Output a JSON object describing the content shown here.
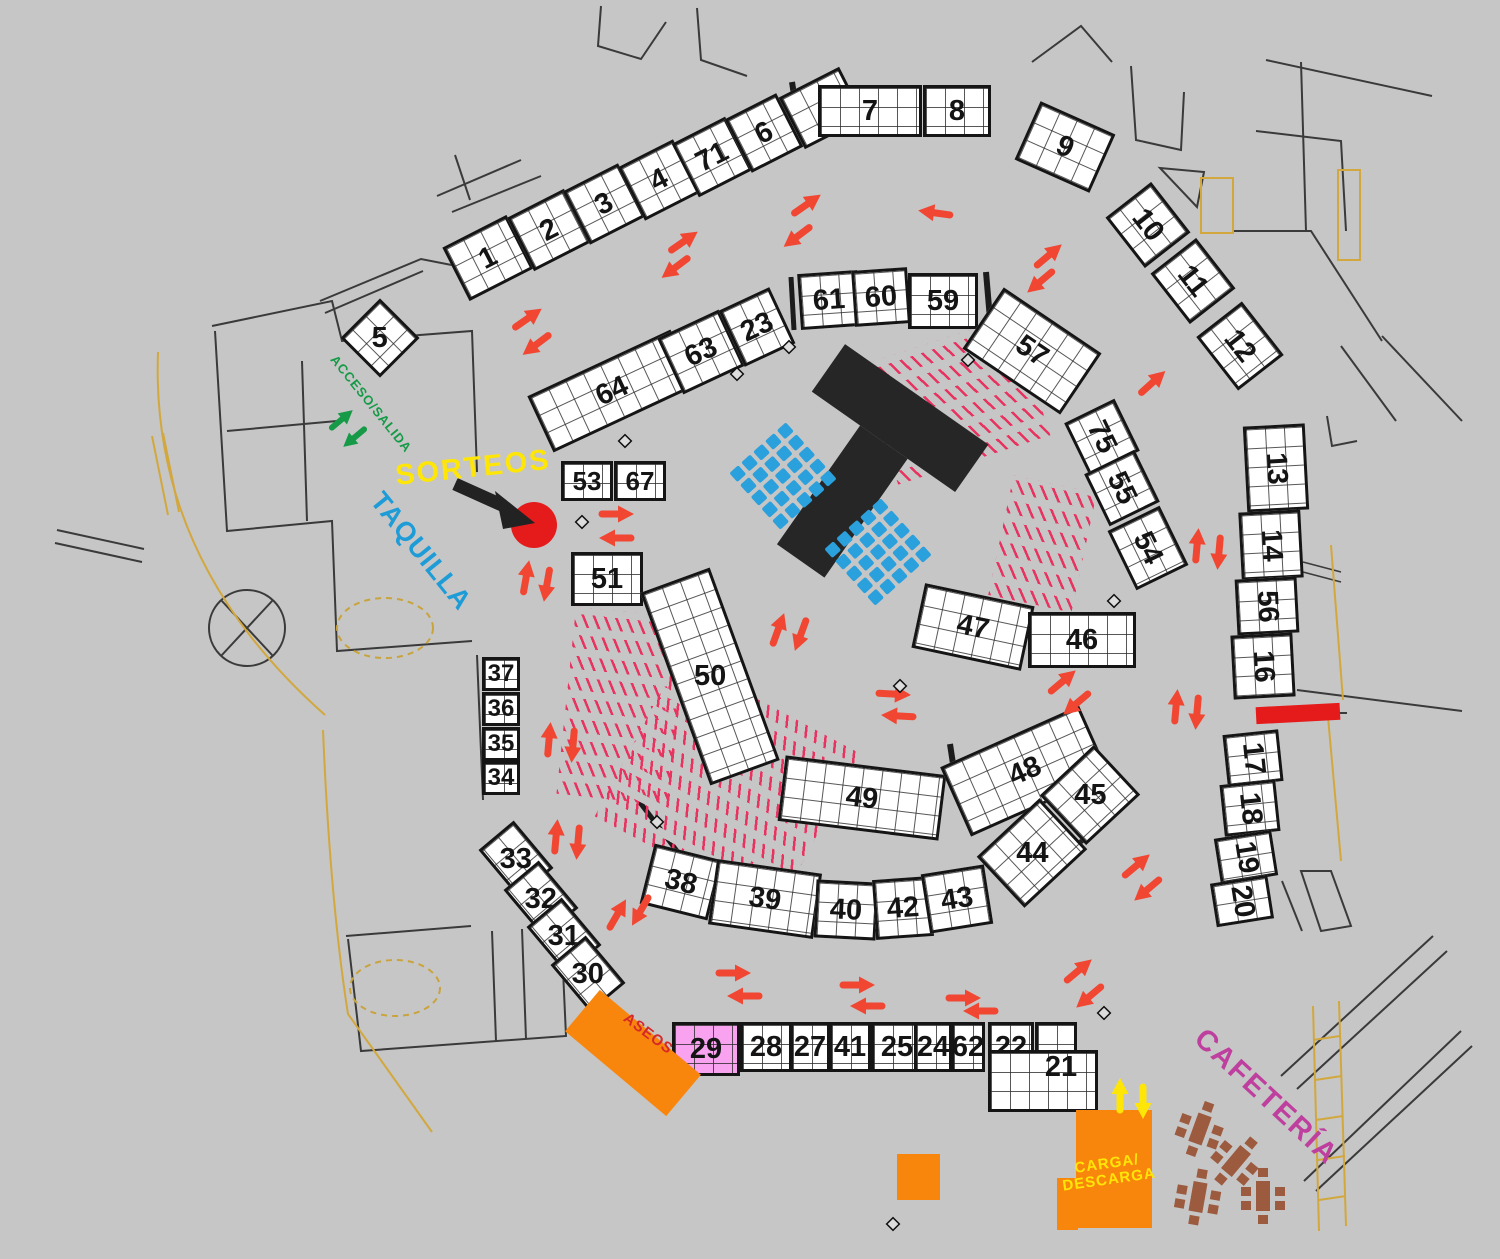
{
  "canvas": {
    "width": 1500,
    "height": 1259,
    "background": "#c6c6c6"
  },
  "palette": {
    "booth_fill": "#ffffff",
    "booth_border": "#151515",
    "number": "#141414",
    "arrow_red": "#f04632",
    "arrow_green": "#169a47",
    "arrow_yellow": "#ffe606",
    "hatch_pink": "#e8325f",
    "chair_blue": "#2aa0dc",
    "stage_black": "#262626",
    "orange": "#f8860d",
    "pink_booth": "#f8a2f0",
    "red_accent": "#e51a1a",
    "table_brown": "#9c5a3f",
    "wall": "#3a3a3a",
    "path_yellow": "#d2a83e"
  },
  "labels": [
    {
      "id": "sorteos",
      "text": "SORTEOS",
      "x": 473,
      "y": 468,
      "rot": -6,
      "fs": 29,
      "color": "#ffe606",
      "ls": 2
    },
    {
      "id": "taquilla",
      "text": "TAQUILLA",
      "x": 421,
      "y": 551,
      "rot": 51,
      "fs": 27,
      "color": "#1e9cd7",
      "ls": 1
    },
    {
      "id": "acceso-salida",
      "text": "ACCESO/SALIDA",
      "x": 371,
      "y": 404,
      "rot": 51,
      "fs": 13,
      "color": "#169a47",
      "ls": 1
    },
    {
      "id": "cafeteria",
      "text": "CAFETERÍA",
      "x": 1266,
      "y": 1097,
      "rot": 43,
      "fs": 29,
      "color": "#bf3f9f",
      "ls": 2
    },
    {
      "id": "aseos",
      "text": "ASEOS",
      "x": 648,
      "y": 1034,
      "rot": 37,
      "fs": 15,
      "color": "#d62828",
      "ls": 1
    },
    {
      "id": "carga-descarga",
      "text": "CARGA/\nDESCARGA",
      "x": 1108,
      "y": 1172,
      "rot": -8,
      "fs": 15,
      "color": "#ffe606",
      "ls": 1
    }
  ],
  "booths": [
    {
      "num": "1",
      "cx": 488,
      "cy": 258,
      "w": 72,
      "h": 60,
      "rot": -27
    },
    {
      "num": "2",
      "cx": 549,
      "cy": 230,
      "w": 64,
      "h": 60,
      "rot": -27
    },
    {
      "num": "3",
      "cx": 604,
      "cy": 204,
      "w": 62,
      "h": 60,
      "rot": -27
    },
    {
      "num": "4",
      "cx": 659,
      "cy": 180,
      "w": 62,
      "h": 60,
      "rot": -27
    },
    {
      "num": "71",
      "cx": 712,
      "cy": 157,
      "w": 60,
      "h": 60,
      "rot": -27
    },
    {
      "num": "6",
      "cx": 764,
      "cy": 133,
      "w": 58,
      "h": 60,
      "rot": -27
    },
    {
      "num": "",
      "cx": 822,
      "cy": 108,
      "w": 68,
      "h": 58,
      "rot": -27
    },
    {
      "num": "7",
      "cx": 870,
      "cy": 111,
      "w": 104,
      "h": 52,
      "rot": 0
    },
    {
      "num": "8",
      "cx": 957,
      "cy": 111,
      "w": 68,
      "h": 52,
      "rot": 0
    },
    {
      "num": "9",
      "cx": 1065,
      "cy": 147,
      "w": 82,
      "h": 64,
      "rot": 24
    },
    {
      "num": "10",
      "cx": 1148,
      "cy": 225,
      "w": 64,
      "h": 58,
      "rot": 52
    },
    {
      "num": "11",
      "cx": 1193,
      "cy": 281,
      "w": 64,
      "h": 58,
      "rot": 52
    },
    {
      "num": "12",
      "cx": 1240,
      "cy": 346,
      "w": 68,
      "h": 58,
      "rot": 52
    },
    {
      "num": "13",
      "cx": 1276,
      "cy": 468,
      "w": 62,
      "h": 86,
      "rot": -3,
      "nr": 90
    },
    {
      "num": "14",
      "cx": 1271,
      "cy": 545,
      "w": 62,
      "h": 68,
      "rot": -3,
      "nr": 90
    },
    {
      "num": "56",
      "cx": 1267,
      "cy": 606,
      "w": 62,
      "h": 56,
      "rot": -3,
      "nr": 90
    },
    {
      "num": "16",
      "cx": 1263,
      "cy": 666,
      "w": 62,
      "h": 64,
      "rot": -3,
      "nr": 90
    },
    {
      "num": "17",
      "cx": 1253,
      "cy": 758,
      "w": 56,
      "h": 52,
      "rot": -6,
      "nr": 90
    },
    {
      "num": "18",
      "cx": 1250,
      "cy": 808,
      "w": 56,
      "h": 52,
      "rot": -6,
      "nr": 90
    },
    {
      "num": "19",
      "cx": 1246,
      "cy": 857,
      "w": 58,
      "h": 46,
      "rot": -9,
      "nr": 90
    },
    {
      "num": "20",
      "cx": 1242,
      "cy": 901,
      "w": 58,
      "h": 44,
      "rot": -9,
      "nr": 90
    },
    {
      "num": "64",
      "cx": 612,
      "cy": 391,
      "w": 158,
      "h": 62,
      "rot": -25
    },
    {
      "num": "63",
      "cx": 701,
      "cy": 352,
      "w": 68,
      "h": 62,
      "rot": -25
    },
    {
      "num": "23",
      "cx": 757,
      "cy": 327,
      "w": 56,
      "h": 62,
      "rot": -25
    },
    {
      "num": "61",
      "cx": 829,
      "cy": 300,
      "w": 60,
      "h": 56,
      "rot": -4
    },
    {
      "num": "60",
      "cx": 881,
      "cy": 297,
      "w": 56,
      "h": 56,
      "rot": -4
    },
    {
      "num": "59",
      "cx": 943,
      "cy": 301,
      "w": 70,
      "h": 56,
      "rot": 0
    },
    {
      "num": "57",
      "cx": 1032,
      "cy": 351,
      "w": 118,
      "h": 74,
      "rot": 34
    },
    {
      "num": "75",
      "cx": 1102,
      "cy": 437,
      "w": 58,
      "h": 56,
      "rot": 64
    },
    {
      "num": "55",
      "cx": 1122,
      "cy": 488,
      "w": 58,
      "h": 56,
      "rot": 64
    },
    {
      "num": "54",
      "cx": 1148,
      "cy": 548,
      "w": 66,
      "h": 58,
      "rot": 64
    },
    {
      "num": "53",
      "cx": 587,
      "cy": 481,
      "w": 52,
      "h": 40,
      "rot": 0,
      "fs": 26
    },
    {
      "num": "67",
      "cx": 640,
      "cy": 481,
      "w": 52,
      "h": 40,
      "rot": 0,
      "fs": 26
    },
    {
      "num": "51",
      "cx": 607,
      "cy": 579,
      "w": 72,
      "h": 54,
      "rot": 0
    },
    {
      "num": "50",
      "cx": 710,
      "cy": 676,
      "w": 74,
      "h": 205,
      "rot": -20,
      "nr": 20
    },
    {
      "num": "47",
      "cx": 973,
      "cy": 627,
      "w": 112,
      "h": 66,
      "rot": 12
    },
    {
      "num": "46",
      "cx": 1082,
      "cy": 640,
      "w": 108,
      "h": 56,
      "rot": 0
    },
    {
      "num": "49",
      "cx": 862,
      "cy": 798,
      "w": 162,
      "h": 66,
      "rot": 7
    },
    {
      "num": "48",
      "cx": 1025,
      "cy": 771,
      "w": 152,
      "h": 76,
      "rot": -24
    },
    {
      "num": "45",
      "cx": 1090,
      "cy": 795,
      "w": 74,
      "h": 68,
      "rot": -43,
      "nr": 43
    },
    {
      "num": "44",
      "cx": 1032,
      "cy": 853,
      "w": 86,
      "h": 70,
      "rot": -43,
      "nr": 43
    },
    {
      "num": "38",
      "cx": 681,
      "cy": 882,
      "w": 70,
      "h": 62,
      "rot": 14
    },
    {
      "num": "39",
      "cx": 765,
      "cy": 899,
      "w": 106,
      "h": 66,
      "rot": 8
    },
    {
      "num": "40",
      "cx": 846,
      "cy": 910,
      "w": 62,
      "h": 58,
      "rot": 3
    },
    {
      "num": "42",
      "cx": 903,
      "cy": 908,
      "w": 58,
      "h": 60,
      "rot": -4
    },
    {
      "num": "43",
      "cx": 957,
      "cy": 899,
      "w": 64,
      "h": 60,
      "rot": -9
    },
    {
      "num": "37",
      "cx": 501,
      "cy": 674,
      "w": 38,
      "h": 34,
      "rot": 0,
      "fs": 24
    },
    {
      "num": "36",
      "cx": 501,
      "cy": 709,
      "w": 38,
      "h": 34,
      "rot": 0,
      "fs": 24
    },
    {
      "num": "35",
      "cx": 501,
      "cy": 744,
      "w": 38,
      "h": 34,
      "rot": 0,
      "fs": 24
    },
    {
      "num": "34",
      "cx": 501,
      "cy": 778,
      "w": 38,
      "h": 34,
      "rot": 0,
      "fs": 24
    },
    {
      "num": "33",
      "cx": 516,
      "cy": 859,
      "w": 62,
      "h": 46,
      "rot": 50,
      "nr": -50
    },
    {
      "num": "32",
      "cx": 541,
      "cy": 899,
      "w": 62,
      "h": 46,
      "rot": 50,
      "nr": -50
    },
    {
      "num": "31",
      "cx": 564,
      "cy": 936,
      "w": 62,
      "h": 46,
      "rot": 50,
      "nr": -50
    },
    {
      "num": "30",
      "cx": 588,
      "cy": 974,
      "w": 62,
      "h": 46,
      "rot": 50,
      "nr": -50
    },
    {
      "num": "29",
      "cx": 706,
      "cy": 1049,
      "w": 68,
      "h": 54,
      "rot": 0,
      "fill": "#f8a2f0"
    },
    {
      "num": "28",
      "cx": 766,
      "cy": 1047,
      "w": 52,
      "h": 50,
      "rot": 0
    },
    {
      "num": "27",
      "cx": 810,
      "cy": 1047,
      "w": 40,
      "h": 50,
      "rot": 0
    },
    {
      "num": "41",
      "cx": 850,
      "cy": 1047,
      "w": 42,
      "h": 50,
      "rot": 0
    },
    {
      "num": "25",
      "cx": 897,
      "cy": 1047,
      "w": 52,
      "h": 50,
      "rot": 0
    },
    {
      "num": "24",
      "cx": 933,
      "cy": 1047,
      "w": 38,
      "h": 50,
      "rot": 0
    },
    {
      "num": "62",
      "cx": 968,
      "cy": 1047,
      "w": 34,
      "h": 50,
      "rot": 0
    },
    {
      "num": "22",
      "cx": 1011,
      "cy": 1047,
      "w": 46,
      "h": 50,
      "rot": 0
    },
    {
      "num": "",
      "cx": 1056,
      "cy": 1047,
      "w": 42,
      "h": 50,
      "rot": 0
    },
    {
      "num": "21",
      "cx": 1043,
      "cy": 1081,
      "w": 110,
      "h": 62,
      "rot": 0,
      "nx": 18,
      "ny": -14
    },
    {
      "num": "5",
      "cx": 380,
      "cy": 338,
      "w": 56,
      "h": 56,
      "rot": 45,
      "nr": -45
    }
  ],
  "arrows_red": [
    [
      806,
      205,
      -35
    ],
    [
      798,
      236,
      143
    ],
    [
      936,
      213,
      188
    ],
    [
      683,
      242,
      -35
    ],
    [
      676,
      267,
      143
    ],
    [
      1048,
      256,
      -40
    ],
    [
      1041,
      281,
      140
    ],
    [
      527,
      319,
      -35
    ],
    [
      537,
      344,
      143
    ],
    [
      1152,
      383,
      -42
    ],
    [
      616,
      514,
      0
    ],
    [
      617,
      538,
      180
    ],
    [
      526,
      578,
      -80
    ],
    [
      547,
      584,
      100
    ],
    [
      1197,
      546,
      -85
    ],
    [
      1219,
      552,
      95
    ],
    [
      893,
      694,
      3
    ],
    [
      899,
      716,
      183
    ],
    [
      1062,
      682,
      -40
    ],
    [
      1077,
      703,
      140
    ],
    [
      778,
      630,
      -70
    ],
    [
      801,
      634,
      110
    ],
    [
      1176,
      707,
      -85
    ],
    [
      1197,
      712,
      95
    ],
    [
      549,
      740,
      -85
    ],
    [
      573,
      745,
      95
    ],
    [
      556,
      837,
      -85
    ],
    [
      578,
      842,
      95
    ],
    [
      617,
      915,
      -60
    ],
    [
      641,
      910,
      120
    ],
    [
      1136,
      866,
      -40
    ],
    [
      1148,
      889,
      140
    ],
    [
      1078,
      971,
      -40
    ],
    [
      1090,
      996,
      140
    ],
    [
      733,
      973,
      0
    ],
    [
      745,
      996,
      180
    ],
    [
      857,
      985,
      0
    ],
    [
      868,
      1006,
      180
    ],
    [
      963,
      998,
      0
    ],
    [
      981,
      1011,
      180
    ]
  ],
  "arrows_green": [
    [
      341,
      420,
      -40
    ],
    [
      355,
      437,
      140
    ]
  ],
  "arrows_yellow": [
    [
      1120,
      1096,
      -90
    ],
    [
      1143,
      1101,
      90
    ]
  ],
  "markers": [
    [
      625,
      441
    ],
    [
      582,
      522
    ],
    [
      968,
      360
    ],
    [
      1114,
      601
    ],
    [
      900,
      686
    ],
    [
      657,
      822
    ],
    [
      1104,
      1013
    ],
    [
      893,
      1224
    ],
    [
      737,
      374
    ],
    [
      789,
      347
    ]
  ],
  "hatches": [
    {
      "x": 875,
      "y": 338,
      "w": 160,
      "h": 125,
      "rot": -18,
      "tick": 62
    },
    {
      "x": 1000,
      "y": 483,
      "w": 85,
      "h": 122,
      "rot": 12,
      "tick": 55
    },
    {
      "x": 566,
      "y": 612,
      "w": 112,
      "h": 188,
      "rot": 6,
      "tick": 62
    },
    {
      "x": 625,
      "y": 695,
      "w": 205,
      "h": 180,
      "rot": 28,
      "tick": 68
    }
  ],
  "chair_grids": [
    {
      "cx": 783,
      "cy": 476,
      "rows": 5,
      "cols": 5,
      "rot": -42
    },
    {
      "cx": 878,
      "cy": 552,
      "rows": 5,
      "cols": 5,
      "rot": -42
    }
  ],
  "stage": {
    "cx": 858,
    "cy": 477,
    "rot": 35,
    "bar_w": 175,
    "bar_h": 58,
    "stem_w": 58,
    "stem_h": 145
  },
  "tables": [
    {
      "cx": 1200,
      "cy": 1129,
      "rot": 20
    },
    {
      "cx": 1236,
      "cy": 1161,
      "rot": 40
    },
    {
      "cx": 1198,
      "cy": 1197,
      "rot": 10
    },
    {
      "cx": 1263,
      "cy": 1196,
      "rot": 0
    }
  ],
  "shapes": {
    "red_bar": {
      "x": 1256,
      "y": 705,
      "w": 84,
      "h": 17,
      "rot": -3
    },
    "red_dot": {
      "cx": 534,
      "cy": 525,
      "r": 23
    },
    "aseos_block": {
      "cx": 633,
      "cy": 1053,
      "w": 132,
      "h": 54,
      "rot": 40
    },
    "carga_block": {
      "x": 1076,
      "y": 1110,
      "w": 76,
      "h": 118
    },
    "carga_notch": {
      "x": 1057,
      "y": 1178,
      "w": 21,
      "h": 52
    },
    "orange_square": {
      "x": 897,
      "y": 1154,
      "w": 43,
      "h": 46
    }
  }
}
